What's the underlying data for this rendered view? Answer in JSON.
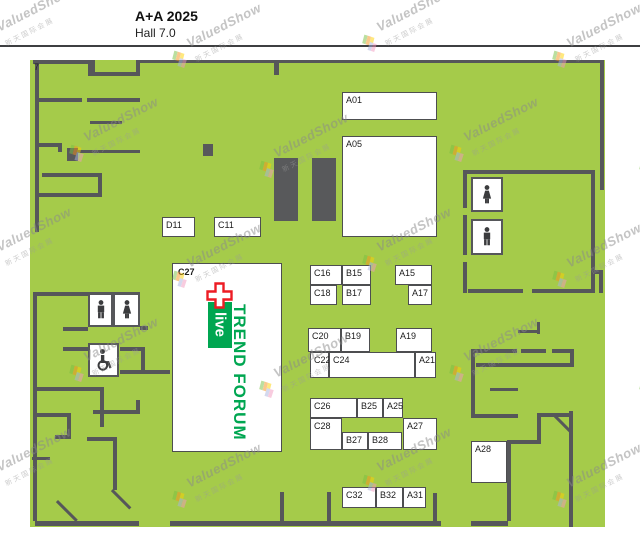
{
  "header": {
    "title": "A+A 2025",
    "subtitle": "Hall 7.0"
  },
  "hall_number": "7",
  "colors": {
    "floor_green": "#a5cb4a",
    "wall_gray": "#56575a",
    "forum_green": "#00a651",
    "cross_red": "#ed1c24",
    "booth_white": "#ffffff"
  },
  "booths": [
    {
      "label": "A01",
      "x": 342,
      "y": 92,
      "w": 95,
      "h": 28
    },
    {
      "label": "A05",
      "x": 342,
      "y": 136,
      "w": 95,
      "h": 101
    },
    {
      "label": "D11",
      "x": 162,
      "y": 217,
      "w": 33,
      "h": 20
    },
    {
      "label": "C11",
      "x": 214,
      "y": 217,
      "w": 47,
      "h": 20
    },
    {
      "label": "C16",
      "x": 310,
      "y": 265,
      "w": 32,
      "h": 20
    },
    {
      "label": "B15",
      "x": 342,
      "y": 265,
      "w": 29,
      "h": 20
    },
    {
      "label": "A15",
      "x": 395,
      "y": 265,
      "w": 37,
      "h": 20
    },
    {
      "label": "C18",
      "x": 310,
      "y": 285,
      "w": 27,
      "h": 20
    },
    {
      "label": "B17",
      "x": 342,
      "y": 285,
      "w": 29,
      "h": 20
    },
    {
      "label": "A17",
      "x": 408,
      "y": 285,
      "w": 24,
      "h": 20
    },
    {
      "label": "C20",
      "x": 308,
      "y": 328,
      "w": 33,
      "h": 24
    },
    {
      "label": "B19",
      "x": 341,
      "y": 328,
      "w": 29,
      "h": 24
    },
    {
      "label": "A19",
      "x": 396,
      "y": 328,
      "w": 36,
      "h": 24
    },
    {
      "label": "C22",
      "x": 310,
      "y": 352,
      "w": 19,
      "h": 26
    },
    {
      "label": "C24",
      "x": 329,
      "y": 352,
      "w": 86,
      "h": 26
    },
    {
      "label": "A21",
      "x": 415,
      "y": 352,
      "w": 21,
      "h": 26
    },
    {
      "label": "C26",
      "x": 310,
      "y": 398,
      "w": 47,
      "h": 20
    },
    {
      "label": "B25",
      "x": 357,
      "y": 398,
      "w": 26,
      "h": 20
    },
    {
      "label": "A25",
      "x": 383,
      "y": 398,
      "w": 20,
      "h": 20
    },
    {
      "label": "C28",
      "x": 310,
      "y": 418,
      "w": 32,
      "h": 32
    },
    {
      "label": "B27",
      "x": 342,
      "y": 432,
      "w": 26,
      "h": 18
    },
    {
      "label": "B28",
      "x": 368,
      "y": 432,
      "w": 34,
      "h": 18
    },
    {
      "label": "A27",
      "x": 403,
      "y": 418,
      "w": 34,
      "h": 32
    },
    {
      "label": "C32",
      "x": 342,
      "y": 487,
      "w": 34,
      "h": 21
    },
    {
      "label": "B32",
      "x": 376,
      "y": 487,
      "w": 27,
      "h": 21
    },
    {
      "label": "A31",
      "x": 403,
      "y": 487,
      "w": 23,
      "h": 21
    },
    {
      "label": "A28",
      "x": 471,
      "y": 441,
      "w": 36,
      "h": 42
    }
  ],
  "trend_forum": {
    "booth_label": "C27",
    "title": "TREND FORUM",
    "logo_text": "live"
  },
  "facilities": [
    {
      "type": "mens-restroom",
      "icon": "man-icon",
      "x": 88,
      "y": 293,
      "w": 25,
      "h": 34
    },
    {
      "type": "womens-restroom",
      "icon": "woman-icon",
      "x": 113,
      "y": 293,
      "w": 27,
      "h": 34
    },
    {
      "type": "accessible-restroom",
      "icon": "wheelchair-icon",
      "x": 88,
      "y": 343,
      "w": 31,
      "h": 34
    },
    {
      "type": "womens-restroom",
      "icon": "woman-icon",
      "x": 471,
      "y": 177,
      "w": 32,
      "h": 35
    },
    {
      "type": "mens-restroom",
      "icon": "man-icon",
      "x": 471,
      "y": 219,
      "w": 32,
      "h": 36
    }
  ],
  "watermark": {
    "text": "ValuedShow",
    "subtext": "新天国际会展"
  }
}
